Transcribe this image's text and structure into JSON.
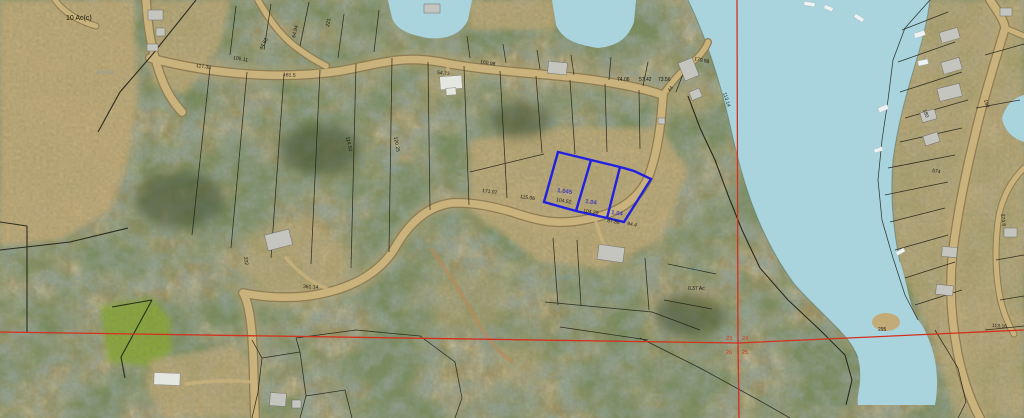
{
  "map_title": "Aerial parcel map with highlighted lots",
  "colors": {
    "lake": "#a9d4de",
    "road": "#c9b27c",
    "roadedge": "#8d7c52",
    "line": "#1f1f15",
    "hl": "#2121e0",
    "red": "#d33120",
    "dim": "#14140c",
    "acre": "#2a2ac8",
    "faint": "#6e9cc4",
    "base": "#a09468",
    "field": "#c2ab79",
    "green": "#8aa83c",
    "bld": "#c4c5bf",
    "dock": "#eef2f2"
  },
  "labels": {
    "region": [
      {
        "t": "10 Ac(c)",
        "x": 66,
        "y": 20,
        "r": 0
      }
    ],
    "dimensions": [
      {
        "t": "105.11",
        "x": 233,
        "y": 59,
        "r": 10
      },
      {
        "t": "117.38",
        "x": 196,
        "y": 67,
        "r": 8
      },
      {
        "t": "161.5",
        "x": 283,
        "y": 76,
        "r": 4
      },
      {
        "t": "44.83",
        "x": 262,
        "y": 50,
        "r": -62
      },
      {
        "t": "64.94",
        "x": 295,
        "y": 38,
        "r": -76
      },
      {
        "t": "221",
        "x": 329,
        "y": 27,
        "r": -80
      },
      {
        "t": "54.73",
        "x": 437,
        "y": 74,
        "r": 6
      },
      {
        "t": "160.98",
        "x": 480,
        "y": 63,
        "r": 10
      },
      {
        "t": "74.06",
        "x": 617,
        "y": 81,
        "r": 0
      },
      {
        "t": "57.42",
        "x": 639,
        "y": 81,
        "r": 0
      },
      {
        "t": "73.56",
        "x": 658,
        "y": 81,
        "r": 0
      },
      {
        "t": "44",
        "x": 670,
        "y": 92,
        "r": -55
      },
      {
        "t": "113.14",
        "x": 723,
        "y": 93,
        "r": 72
      },
      {
        "t": "170.98",
        "x": 694,
        "y": 60,
        "r": 12
      },
      {
        "t": "115.06",
        "x": 520,
        "y": 198,
        "r": 8
      },
      {
        "t": "171.07",
        "x": 482,
        "y": 192,
        "r": 8
      },
      {
        "t": "104.52",
        "x": 556,
        "y": 201,
        "r": 10
      },
      {
        "t": "104.20",
        "x": 583,
        "y": 212,
        "r": 10
      },
      {
        "t": "87.86",
        "x": 607,
        "y": 222,
        "r": 10
      },
      {
        "t": "94.4",
        "x": 627,
        "y": 225,
        "r": 10
      },
      {
        "t": "114.50",
        "x": 346,
        "y": 137,
        "r": 78
      },
      {
        "t": "120.25",
        "x": 394,
        "y": 137,
        "r": 80
      },
      {
        "t": "361.14",
        "x": 303,
        "y": 288,
        "r": 3
      },
      {
        "t": "332",
        "x": 244,
        "y": 257,
        "r": 82
      },
      {
        "t": "0.37 Ac",
        "x": 688,
        "y": 290,
        "r": 0
      },
      {
        "t": "295",
        "x": 878,
        "y": 331,
        "r": 0
      },
      {
        "t": "113.16",
        "x": 992,
        "y": 327,
        "r": 3
      },
      {
        "t": "192",
        "x": 984,
        "y": 100,
        "r": 75
      },
      {
        "t": "180",
        "x": 923,
        "y": 110,
        "r": 70
      },
      {
        "t": "574",
        "x": 932,
        "y": 172,
        "r": 10
      },
      {
        "t": "274.6",
        "x": 1001,
        "y": 214,
        "r": 82
      }
    ],
    "lot_acres": [
      {
        "t": "1.045",
        "x": 557,
        "y": 192,
        "r": 8
      },
      {
        "t": "1.04",
        "x": 585,
        "y": 203,
        "r": 8
      },
      {
        "t": "1.04",
        "x": 611,
        "y": 214,
        "r": 8
      }
    ],
    "parcel_ids": [
      {
        "t": "10.081",
        "x": 96,
        "y": 74,
        "r": 0
      },
      {
        "t": "1.02",
        "x": 390,
        "y": 171,
        "r": 0
      },
      {
        "t": "1.042",
        "x": 557,
        "y": 279,
        "r": 0
      },
      {
        "t": "1.035",
        "x": 684,
        "y": 271,
        "r": 0
      }
    ],
    "section_numbers": [
      {
        "t": "23",
        "x": 726,
        "y": 340,
        "r": 0
      },
      {
        "t": "24",
        "x": 742,
        "y": 340,
        "r": 0
      },
      {
        "t": "26",
        "x": 726,
        "y": 354,
        "r": 0
      },
      {
        "t": "25",
        "x": 742,
        "y": 354,
        "r": 0
      }
    ]
  }
}
